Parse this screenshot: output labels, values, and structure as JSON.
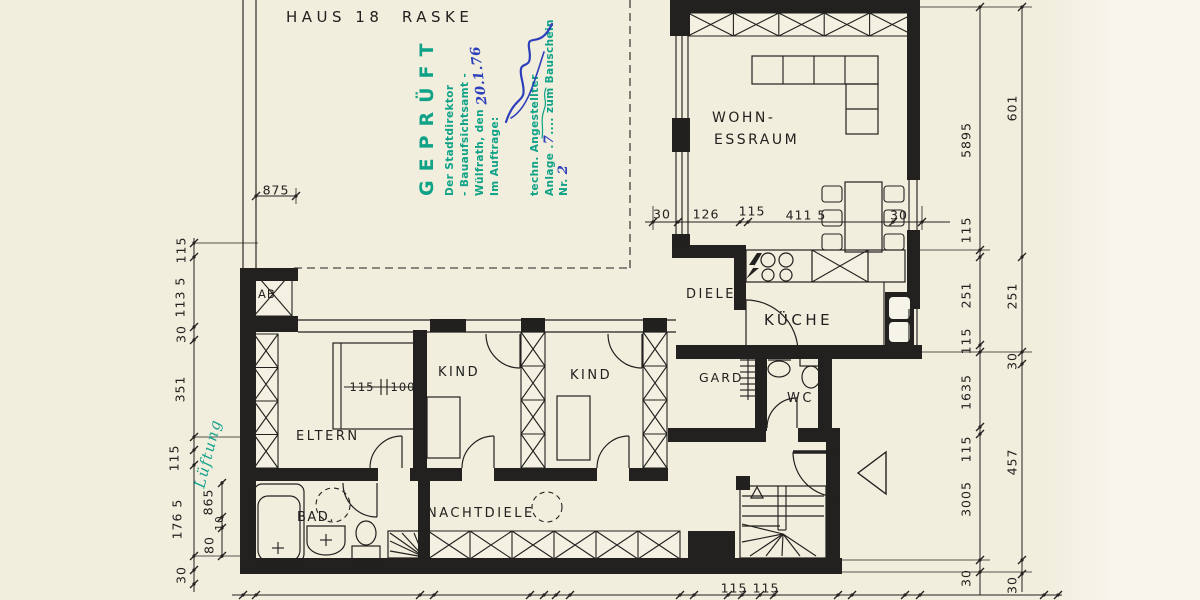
{
  "title": "HAUS 18  RASKE",
  "stamp": {
    "word": "GEPRÜFT",
    "authority": "Der Stadtdirektor",
    "office": "- Bauaufsichtsamt -",
    "city_line": "Wülfrath, den",
    "date_handwritten": "20.1.76",
    "auftrag_line": "Im Auftrage:",
    "role_line": "techn. Angestellter",
    "anlage_prefix": "Anlage .",
    "anlage_number": "7",
    "anlage_mid": ".... zum Bauschein Nr. ",
    "bauschein_number": "2"
  },
  "annotations": {
    "lueftung": "Lüftung"
  },
  "rooms": {
    "wohn_line1": "WOHN-",
    "wohn_line2": "ESSRAUM",
    "diele": "DIELE",
    "kueche": "KÜCHE",
    "gard": "GARD",
    "wc": "WC",
    "kind_1": "KIND",
    "kind_2": "KIND",
    "eltern": "ELTERN",
    "bad": "BAD.",
    "nachtdiele": "NACHTDIELE",
    "ab": "AB"
  },
  "dimensions": [
    {
      "text": "875",
      "x": 276,
      "y": 190,
      "r": 0
    },
    {
      "text": "30",
      "x": 662,
      "y": 214,
      "r": 0
    },
    {
      "text": "126",
      "x": 706,
      "y": 214,
      "r": 0
    },
    {
      "text": "115",
      "x": 752,
      "y": 211,
      "r": 0
    },
    {
      "text": "411 5",
      "x": 806,
      "y": 215,
      "r": 0
    },
    {
      "text": "30",
      "x": 899,
      "y": 215,
      "r": 0
    },
    {
      "text": "5895",
      "x": 966,
      "y": 140,
      "r": -90
    },
    {
      "text": "115",
      "x": 966,
      "y": 230,
      "r": -90
    },
    {
      "text": "251",
      "x": 966,
      "y": 295,
      "r": -90
    },
    {
      "text": "115",
      "x": 966,
      "y": 341,
      "r": -90
    },
    {
      "text": "1635",
      "x": 966,
      "y": 392,
      "r": -90
    },
    {
      "text": "115",
      "x": 966,
      "y": 449,
      "r": -90
    },
    {
      "text": "3005",
      "x": 966,
      "y": 499,
      "r": -90
    },
    {
      "text": "30",
      "x": 966,
      "y": 578,
      "r": -90
    },
    {
      "text": "601",
      "x": 1012,
      "y": 108,
      "r": -90
    },
    {
      "text": "251",
      "x": 1012,
      "y": 296,
      "r": -90
    },
    {
      "text": "30",
      "x": 1012,
      "y": 361,
      "r": -90
    },
    {
      "text": "457",
      "x": 1012,
      "y": 462,
      "r": -90
    },
    {
      "text": "30",
      "x": 1012,
      "y": 585,
      "r": -90
    },
    {
      "text": "115",
      "x": 181,
      "y": 250,
      "r": -90
    },
    {
      "text": "113 5",
      "x": 180,
      "y": 297,
      "r": -90
    },
    {
      "text": "30",
      "x": 181,
      "y": 334,
      "r": -90
    },
    {
      "text": "351",
      "x": 180,
      "y": 389,
      "r": -90
    },
    {
      "text": "115",
      "x": 174,
      "y": 458,
      "r": -90
    },
    {
      "text": "176 5",
      "x": 177,
      "y": 519,
      "r": -90
    },
    {
      "text": "30",
      "x": 181,
      "y": 575,
      "r": -90
    },
    {
      "text": "865",
      "x": 208,
      "y": 502,
      "r": -90
    },
    {
      "text": "10",
      "x": 220,
      "y": 523,
      "r": -90,
      "s": 10.5
    },
    {
      "text": "80",
      "x": 209,
      "y": 545,
      "r": -90
    },
    {
      "text": "115",
      "x": 362,
      "y": 387,
      "r": 0,
      "s": 11.5
    },
    {
      "text": "100",
      "x": 403,
      "y": 387,
      "r": 0,
      "s": 11.5
    },
    {
      "text": "115",
      "x": 734,
      "y": 588,
      "r": 0
    },
    {
      "text": "115",
      "x": 766,
      "y": 588,
      "r": 0
    }
  ],
  "colors": {
    "paper": "#f1eedd",
    "paper_right": "#f7f5ec",
    "ink": "#22211f",
    "stamp_green": "#0fa287",
    "hand_blue": "#2d3fba",
    "hand_teal": "#17a28d"
  }
}
